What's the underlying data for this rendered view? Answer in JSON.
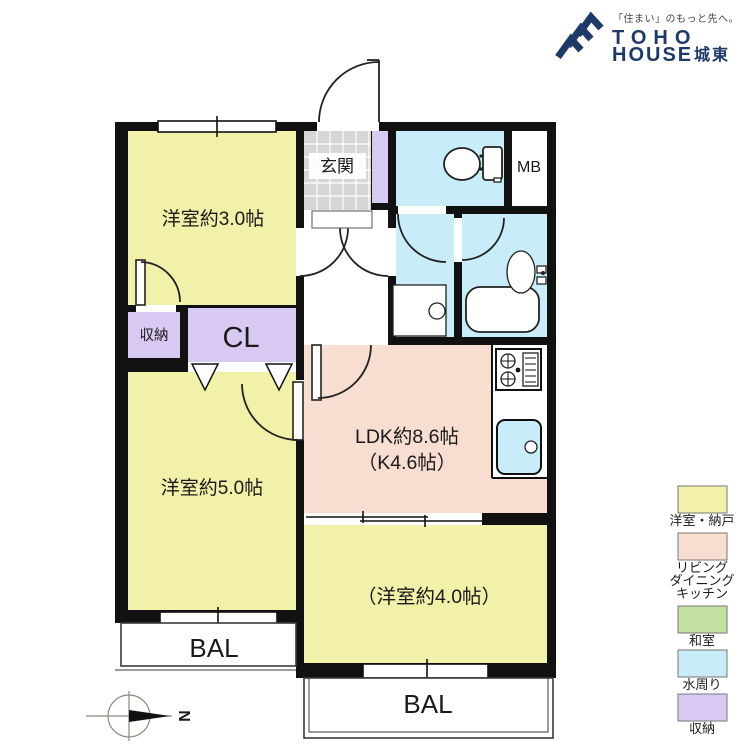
{
  "logo": {
    "tagline": "「住まい」のもっと先へ。",
    "name_line1": "TOHO",
    "name_line2": "HOUSE",
    "region": "城東"
  },
  "plan": {
    "west_room_3": "洋室約3.0帖",
    "entrance": "玄関",
    "meter_box": "MB",
    "storage": "収納",
    "closet": "CL",
    "west_room_5": "洋室約5.0帖",
    "ldk_line1": "LDK約8.6帖",
    "ldk_line2": "（K4.6帖）",
    "west_room_4": "（洋室約4.0帖）",
    "balcony_left": "BAL",
    "balcony_bottom": "BAL"
  },
  "legend": {
    "items": [
      {
        "color": "#f1f1a9",
        "lines": [
          "洋室・納戸"
        ]
      },
      {
        "color": "#f8ded1",
        "lines": [
          "リビング",
          "ダイニング",
          "キッチン"
        ]
      },
      {
        "color": "#c3e2a1",
        "lines": [
          "和室"
        ]
      },
      {
        "color": "#c9ecf9",
        "lines": [
          "水周り"
        ]
      },
      {
        "color": "#d8c9f3",
        "lines": [
          "収納"
        ]
      }
    ]
  },
  "compass": {
    "north": "N"
  },
  "colors": {
    "room_yellow": "#f1f1a9",
    "ldk_pink": "#f8ded1",
    "wet_blue": "#c9ecf9",
    "closet_purple": "#d8c9f3",
    "tile_gray": "#d6d6d6",
    "tatami_green": "#c3e2a1",
    "wall_black": "#111111",
    "brand_navy": "#1e3a68"
  }
}
